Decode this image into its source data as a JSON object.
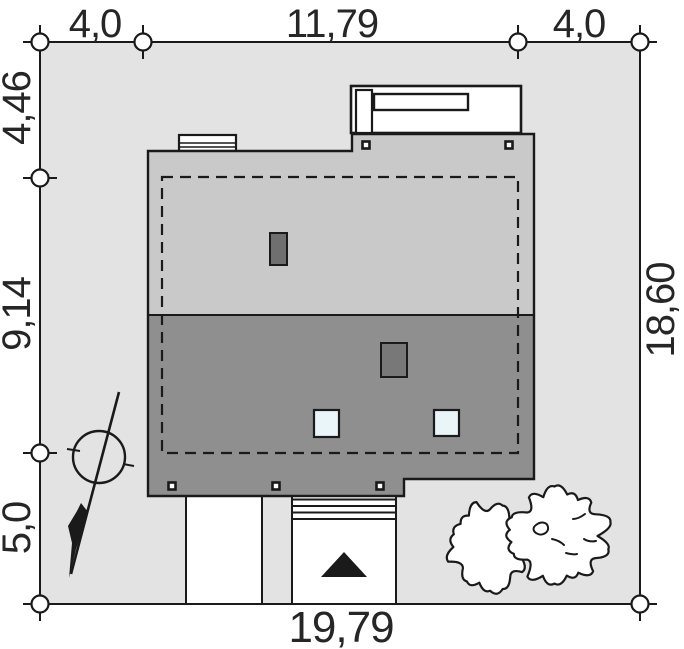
{
  "plan": {
    "type": "architectural site plan",
    "dimensions": {
      "top": [
        "4,0",
        "11,79",
        "4,0"
      ],
      "left": [
        "4,46",
        "9,14",
        "5,0"
      ],
      "right": [
        "18,60"
      ],
      "bottom": [
        "19,79"
      ]
    },
    "colors": {
      "plot_fill": "#e3e3e3",
      "roof_upper": "#c9c9c9",
      "roof_lower": "#8f8f8f",
      "chimney_upper": "#6f6f6f",
      "chimney_lower": "#787878",
      "roof_window": "#e9f5f8",
      "structure_fill": "#ffffff",
      "line": "#1a1a1a",
      "text": "#262626"
    }
  }
}
